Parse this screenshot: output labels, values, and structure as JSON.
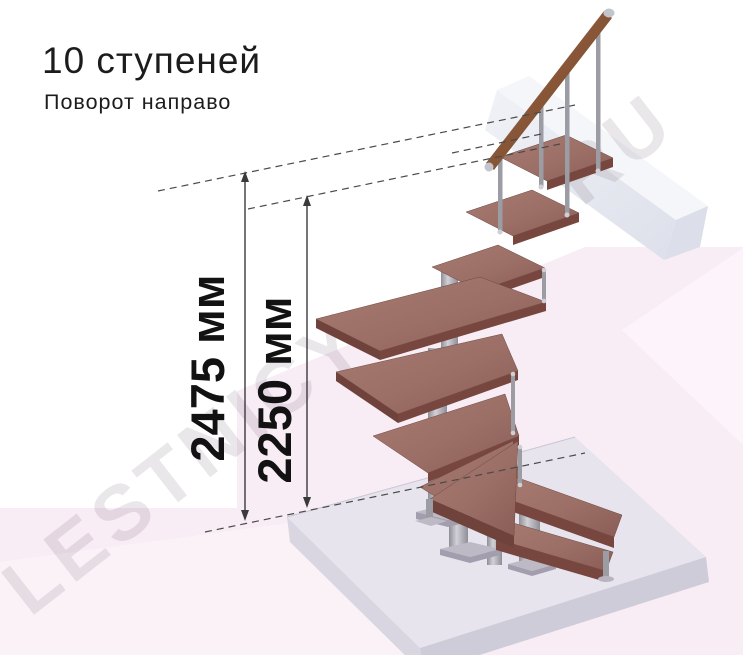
{
  "title": "10 ступеней",
  "subtitle": "Поворот направо",
  "dimensions": {
    "overall_height_label": "2475 мм",
    "upper_level_height_label": "2250 мм"
  },
  "watermark": {
    "fragment_left": "LESTNICY",
    "fragment_right": ".RU"
  },
  "illustration": {
    "steps_shown": 10,
    "colors": {
      "background": "#ffffff",
      "background_pink": "#f8ecf5",
      "tread_wood_top": "#9b6f66",
      "tread_wood_front": "#77473f",
      "handrail_wood": "#8a5a38",
      "metal": "#a6a6ae",
      "floor_slab": "#e7e4ee",
      "landing_beam": "#eef0f6",
      "dimension_ink": "#3a3a3a",
      "text_ink": "#1c1c1c",
      "watermark_ink": "#6b5a6b"
    }
  }
}
